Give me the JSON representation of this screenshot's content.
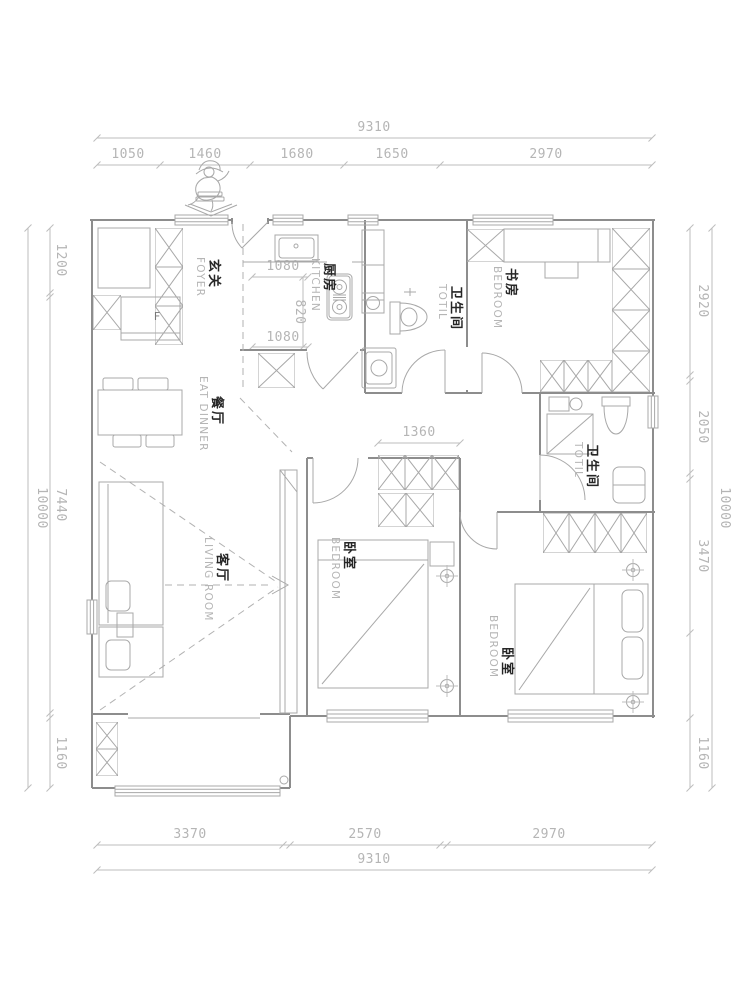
{
  "page": {
    "background": "#ffffff"
  },
  "colors": {
    "wall_line": "#8d8d8d",
    "furniture_line": "#a8a8a8",
    "dashed_line": "#b2b2b2",
    "dimension_line": "#bdbdbd",
    "dimension_text": "#b5b5b5",
    "room_label_zh": "#262626",
    "room_label_en": "#b5b5b5",
    "background": "#ffffff"
  },
  "dims": {
    "top_overall": "9310",
    "top_segments": [
      "1050",
      "1460",
      "1680",
      "1650",
      "2970"
    ],
    "bottom_segments": [
      "3370",
      "2570",
      "2970"
    ],
    "bottom_overall": "9310",
    "left_overall": "10000",
    "left_segments": [
      "1200",
      "7440",
      "1160"
    ],
    "right_segments": [
      "2920",
      "2050",
      "3470",
      "1160"
    ],
    "right_overall": "10000",
    "kitchen_width_top": "1080",
    "kitchen_depth": "820",
    "kitchen_width_bottom": "1080",
    "wardrobe_width": "1360"
  },
  "rooms": {
    "foyer": {
      "zh": "玄关",
      "en": "FOYER"
    },
    "kitchen": {
      "zh": "厨房",
      "en": "KITCHEN"
    },
    "bath1": {
      "zh": "卫生间",
      "en": "TOTIL"
    },
    "study": {
      "zh": "书房",
      "en": "BEDROOM"
    },
    "dining": {
      "zh": "餐厅",
      "en": "EAT DINNER"
    },
    "living": {
      "zh": "客厅",
      "en": "LIVING ROOM"
    },
    "bedroom_mid": {
      "zh": "卧室",
      "en": "BEDROOM"
    },
    "bath2": {
      "zh": "卫生间",
      "en": "TOTIL"
    },
    "bedroom_right": {
      "zh": "卧室",
      "en": "BEDROOM"
    }
  },
  "labels": {
    "fridge": "F"
  }
}
